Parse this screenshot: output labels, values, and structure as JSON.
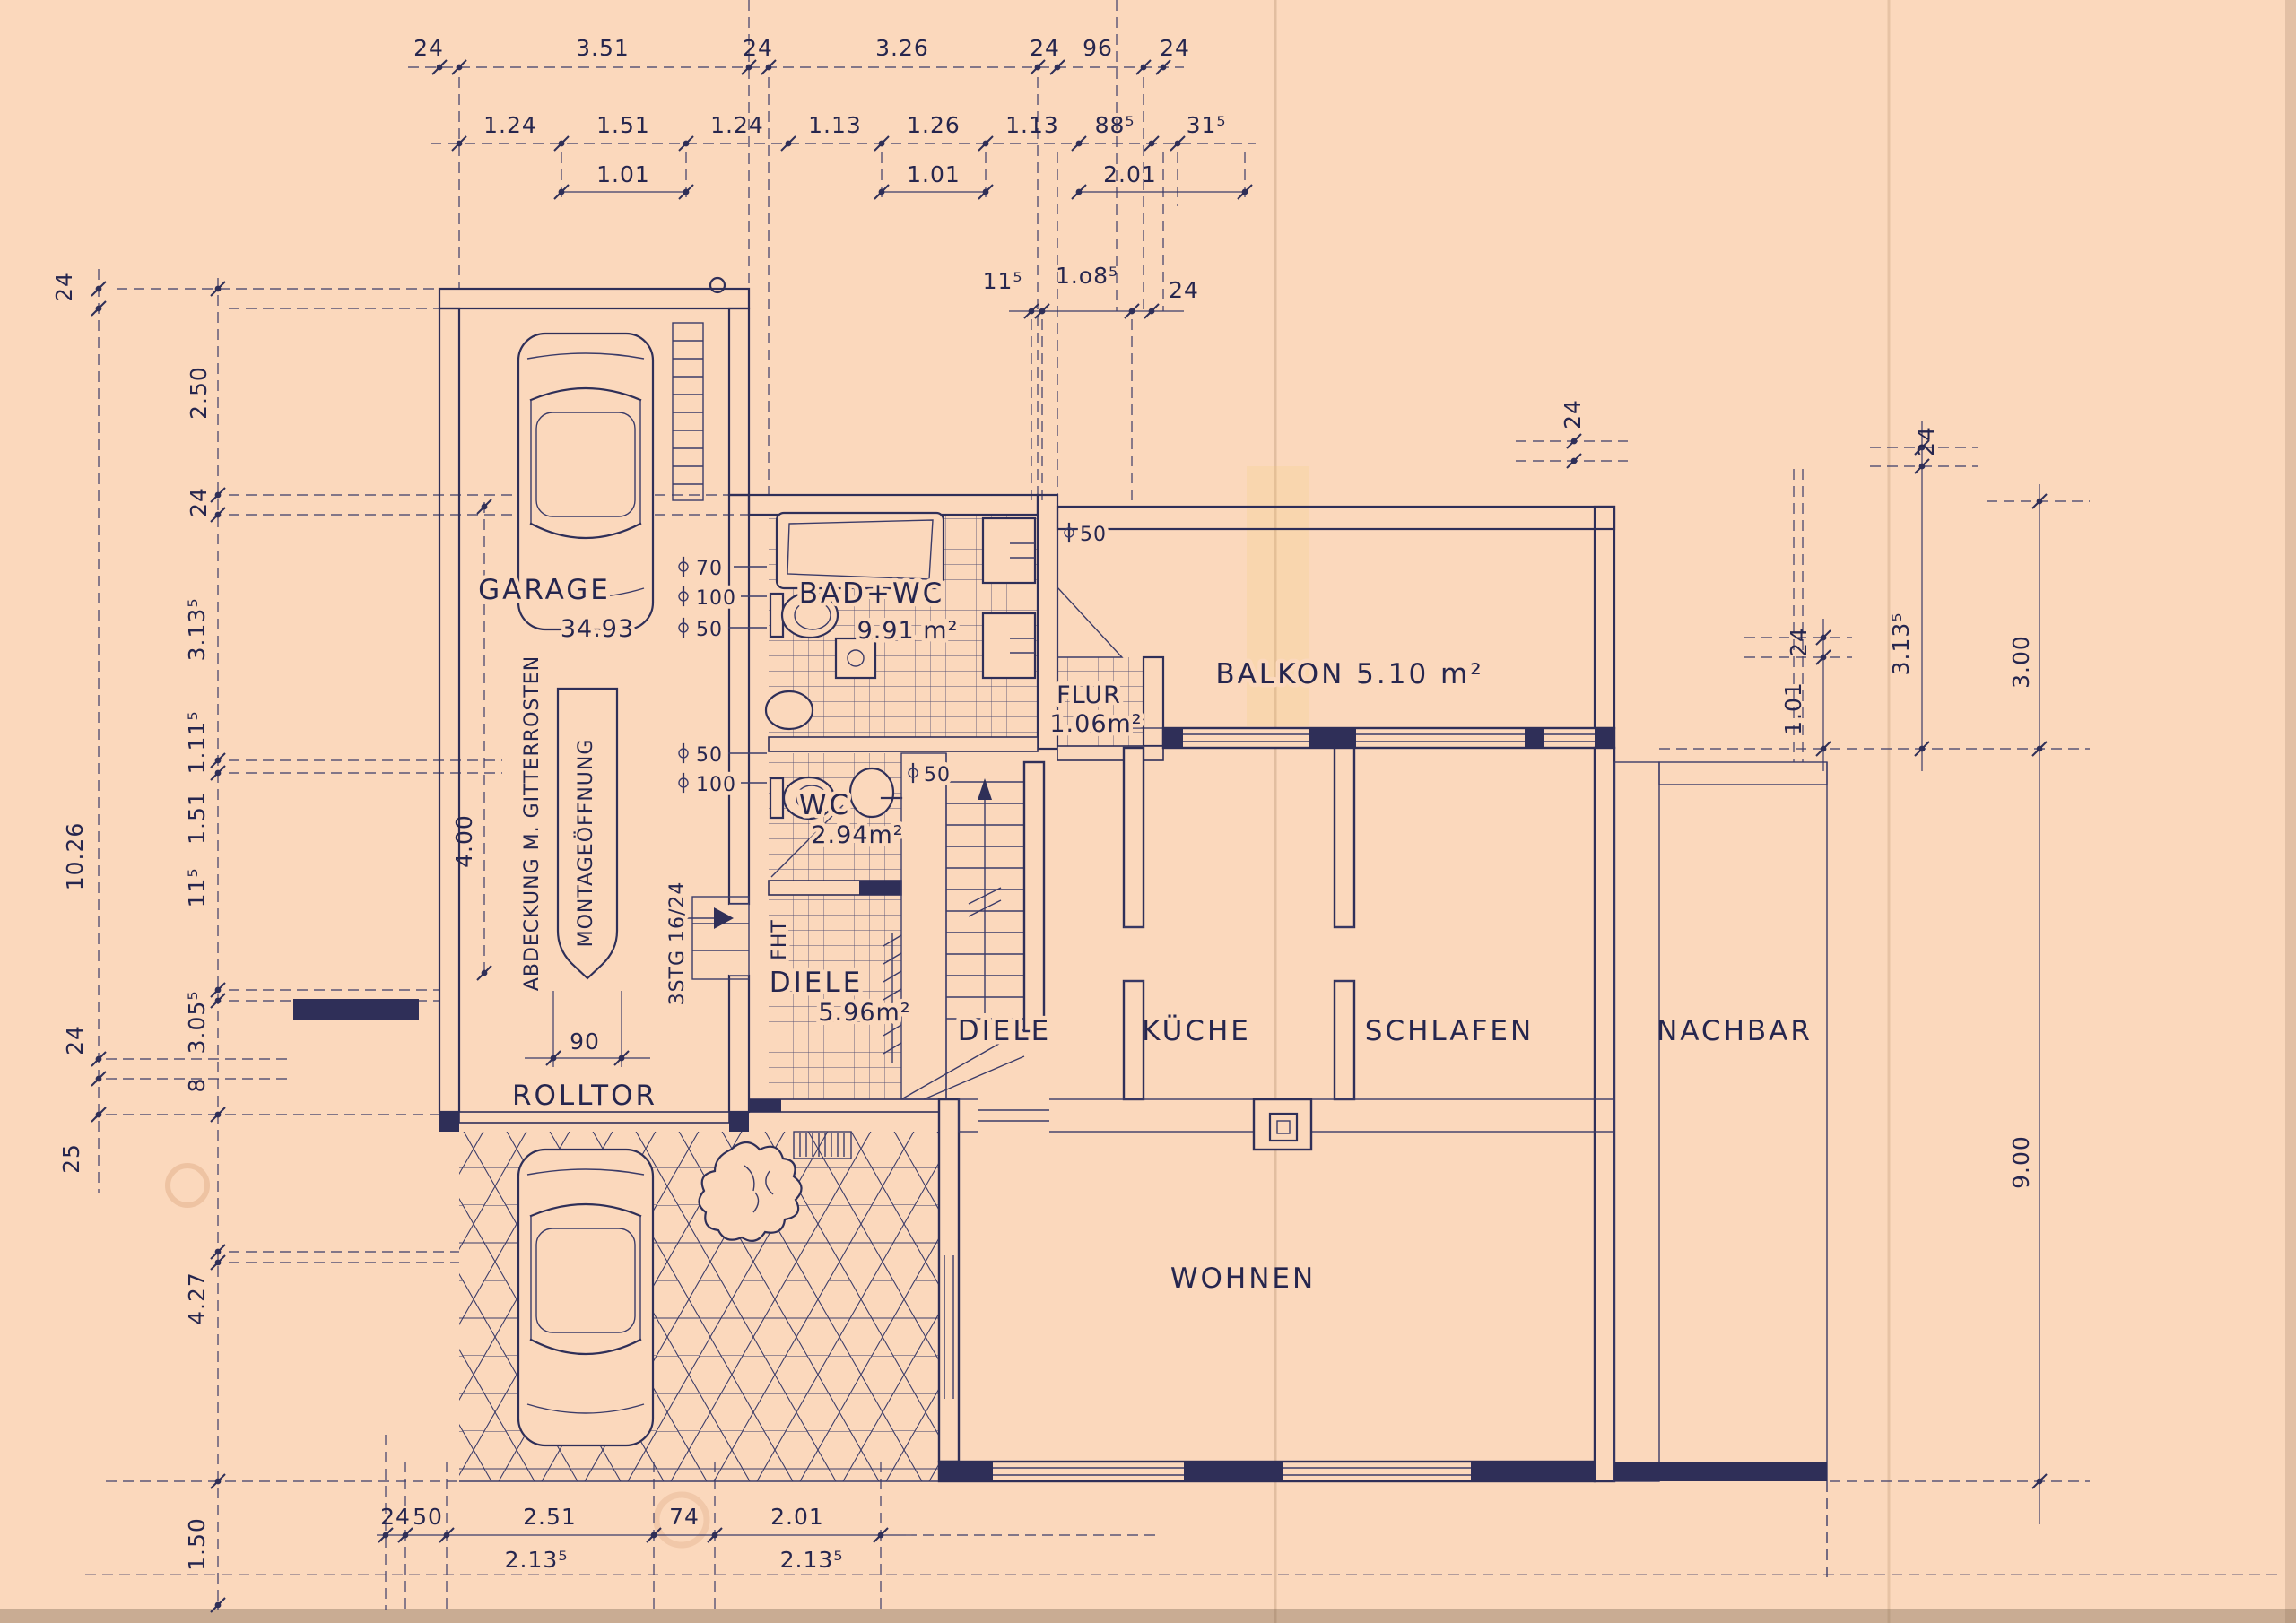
{
  "meta": {
    "paper_color": "#fbd8bc",
    "ink_color": "#2f2f58",
    "drawing_type": "floor plan blueprint"
  },
  "rooms": {
    "garage": {
      "label": "GARAGE",
      "area": "34.93"
    },
    "bad": {
      "label": "BAD+WC",
      "area": "9.91 m²"
    },
    "flur": {
      "label": "FLUR",
      "area": "1.06m²"
    },
    "balkon": {
      "label": "BALKON 5.10 m²"
    },
    "wc": {
      "label": "WC",
      "area": "2.94m²"
    },
    "diele_eg": {
      "label": "DIELE",
      "area": "5.96m²"
    },
    "diele": {
      "label": "DIELE"
    },
    "kueche": {
      "label": "KÜCHE"
    },
    "schlafen": {
      "label": "SCHLAFEN"
    },
    "nachbar": {
      "label": "NACHBAR"
    },
    "wohnen": {
      "label": "WOHNEN"
    }
  },
  "annot": {
    "rolltor": "ROLLTOR",
    "abdeckung": "ABDECKUNG M. GITTERROSTEN",
    "montage": "MONTAGEÖFFNUNG",
    "stg": "3STG 16/24",
    "fht": "FHT",
    "tor_breite": "90",
    "garage_tiefe": "4.00"
  },
  "plumb": {
    "bad": [
      "70",
      "100",
      "50"
    ],
    "wc_left": [
      "50",
      "100"
    ],
    "wc_right": "50",
    "flur": "50"
  },
  "dims": {
    "top1": [
      "24",
      "3.51",
      "24",
      "3.26",
      "24",
      "96",
      "24"
    ],
    "top2": [
      "1.24",
      "1.51",
      "1.24",
      "1.13",
      "1.26",
      "1.13",
      "88⁵",
      "31⁵"
    ],
    "top3": [
      "1.01",
      "1.01",
      "2.01"
    ],
    "small": [
      "11⁵",
      "1.o8⁵",
      "24"
    ],
    "left": {
      "outer_top": "24",
      "outer_span": "10.26",
      "outer_a": "24",
      "outer_b": "25",
      "inner": [
        "2.50",
        "24",
        "3.13⁵",
        "1.11⁵",
        "1.51",
        "11⁵",
        "3.05⁵",
        "8"
      ],
      "lower_a": "4.27",
      "lower_b": "1.50"
    },
    "right": {
      "balkon_wall": "24",
      "wall_top": "24",
      "schlafen_h": "3.13⁵",
      "balkon_len": "3.00",
      "n_wall": "24",
      "n_off": "1.01",
      "total": "9.00"
    },
    "bottom": {
      "row": [
        "24",
        "50",
        "2.51",
        "74",
        "2.01"
      ],
      "sub": [
        "2.13⁵",
        "2.13⁵"
      ]
    }
  }
}
